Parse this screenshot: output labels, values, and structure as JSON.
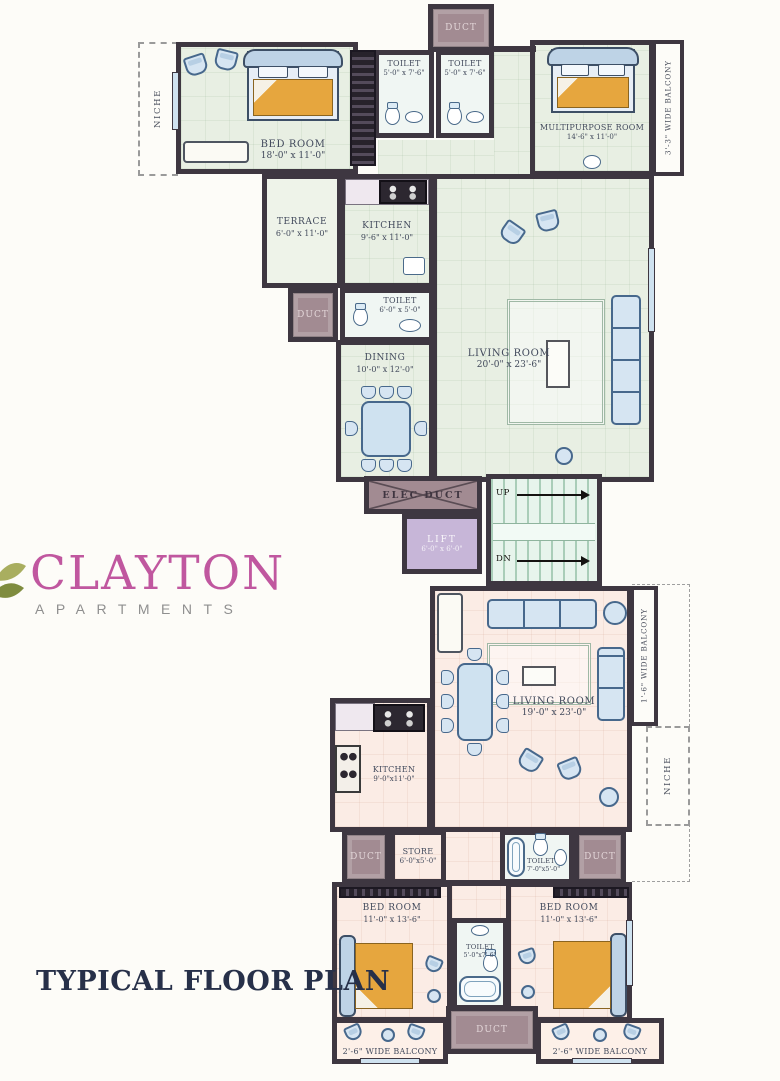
{
  "title": "TYPICAL FLOOR PLAN",
  "brand": {
    "name": "CLAYTON",
    "subtitle": "APARTMENTS"
  },
  "labels": {
    "duct": "DUCT",
    "up": "UP",
    "dn": "DN"
  },
  "rooms": {
    "niche_top": {
      "name": "NICHE"
    },
    "bedroom_top": {
      "name": "BED ROOM",
      "dims": "18'-0\" x 11'-0\""
    },
    "toilet_top_left": {
      "name": "TOILET",
      "dims": "5'-0\" x 7'-6\""
    },
    "toilet_top_right": {
      "name": "TOILET",
      "dims": "5'-0\" x 7'-6\""
    },
    "multipurpose": {
      "name": "MULTIPURPOSE ROOM",
      "dims": "14'-6\" x 11'-0\""
    },
    "balcony_top": {
      "name": "3'-3\" WIDE BALCONY"
    },
    "powder": {
      "name": "POWDER ROOM",
      "dims": "7'-6\" x 5'-0\""
    },
    "terrace": {
      "name": "TERRACE",
      "dims": "6'-0\" x 11'-0\""
    },
    "kitchen_top": {
      "name": "KITCHEN",
      "dims": "9'-6\" x 11'-0\""
    },
    "toilet_mid": {
      "name": "TOILET",
      "dims": "6'-0\" x 5'-0\""
    },
    "dining": {
      "name": "DINING",
      "dims": "10'-0\" x 12'-0\""
    },
    "living_top": {
      "name": "LIVING ROOM",
      "dims": "20'-0\" x 23'-6\""
    },
    "elec": {
      "name": "ELEC DUCT"
    },
    "lift": {
      "name": "LIFT",
      "dims": "6'-0\" x 6'-0\""
    },
    "living_bottom": {
      "name": "LIVING ROOM",
      "dims": "19'-0\" x 23'-0\""
    },
    "balcony_right": {
      "name": "1'-6\" WIDE BALCONY"
    },
    "niche_bottom": {
      "name": "NICHE"
    },
    "kitchen_bottom": {
      "name": "KITCHEN",
      "dims": "9'-0\"x11'-0\""
    },
    "store": {
      "name": "STORE",
      "dims": "6'-0\"x5'-0\""
    },
    "toilet_store": {
      "name": "TOILET",
      "dims": "7'-0\"x5'-0\""
    },
    "bedroom_left": {
      "name": "BED ROOM",
      "dims": "11'-0\" x 13'-6\""
    },
    "toilet_bottom": {
      "name": "TOILET",
      "dims": "5'-0\"x7'-6\""
    },
    "bedroom_right": {
      "name": "BED ROOM",
      "dims": "11'-0\" x 13'-6\""
    },
    "balcony_bottom_left": {
      "name": "2'-6\" WIDE BALCONY"
    },
    "balcony_bottom_right": {
      "name": "2'-6\" WIDE BALCONY"
    }
  },
  "colors": {
    "wall": "#3e3741",
    "floor_upper_unit": "#e8efe3",
    "floor_lower_unit": "#fbece5",
    "duct": "#a28b92",
    "powder_room": "#d8c5c5",
    "lift": "#c7b6d8",
    "stairs": "#e7f4ec",
    "furniture_blue": "#d6e5f2",
    "bed_orange": "#e6a63e",
    "brand_pink": "#c0579f",
    "brand_gray": "#8f8f8f",
    "title_navy": "#273049"
  }
}
